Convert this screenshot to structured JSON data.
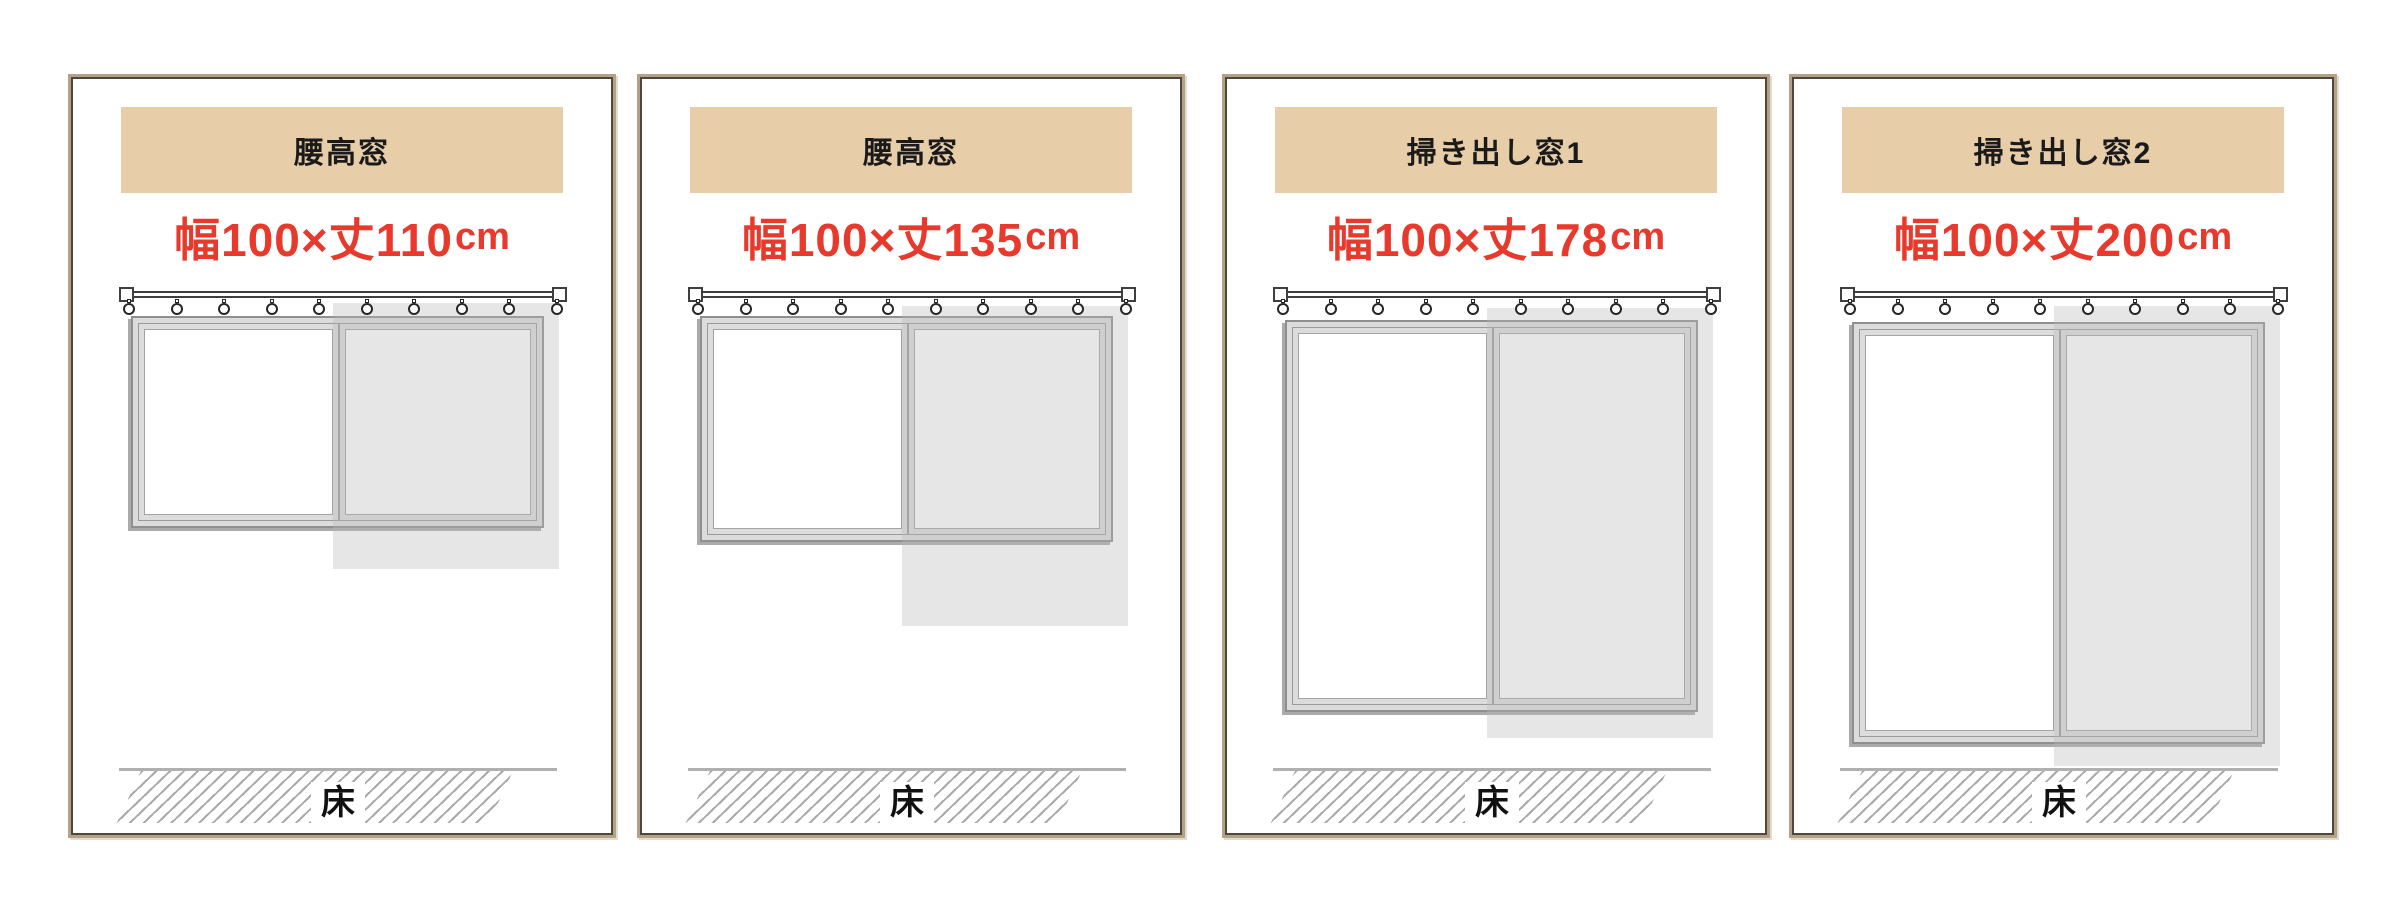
{
  "colors": {
    "header_bg": "#e8cda9",
    "accent_red": "#e8392d",
    "panel_frame": "#b3a287",
    "panel_frame_inner_line": "#51463a",
    "floor_gray": "#b0b0b0"
  },
  "panels": [
    {
      "header": "腰高窓",
      "size_main": "幅100×丈110",
      "size_unit": "cm",
      "curtain_width_cm": 100,
      "curtain_length_cm": 110,
      "floor_label": "床"
    },
    {
      "header": "腰高窓",
      "size_main": "幅100×丈135",
      "size_unit": "cm",
      "curtain_width_cm": 100,
      "curtain_length_cm": 135,
      "floor_label": "床"
    },
    {
      "header": "掃き出し窓1",
      "size_main": "幅100×丈178",
      "size_unit": "cm",
      "curtain_width_cm": 100,
      "curtain_length_cm": 178,
      "floor_label": "床"
    },
    {
      "header": "掃き出し窓2",
      "size_main": "幅100×丈200",
      "size_unit": "cm",
      "curtain_width_cm": 100,
      "curtain_length_cm": 200,
      "floor_label": "床"
    }
  ]
}
